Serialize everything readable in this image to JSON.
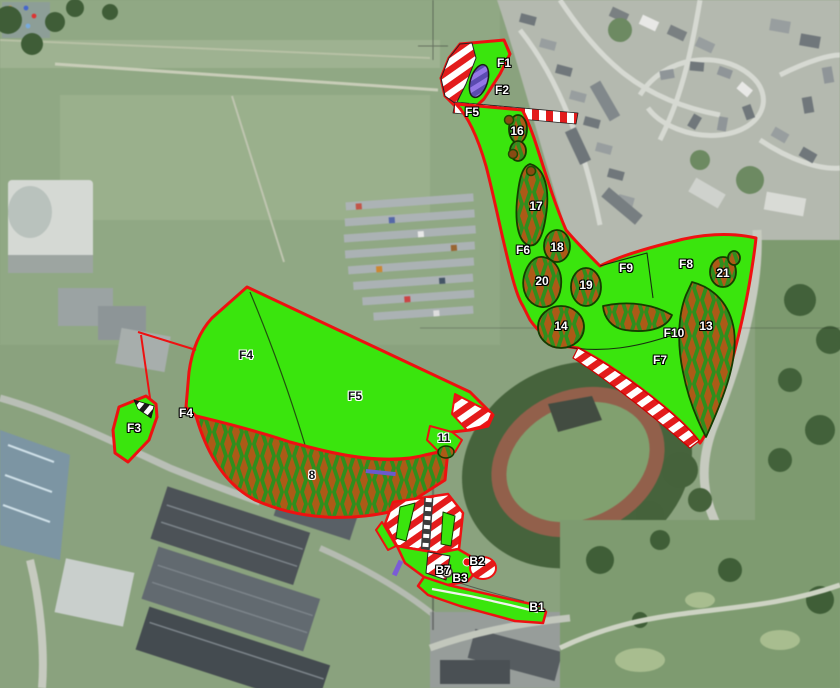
{
  "map": {
    "colors": {
      "zone_green": "#3ae50d",
      "border_red": "#ee1111",
      "checker_green": "#2f8f1d",
      "checker_brown": "#ad5a17",
      "stripe_red": "#e31c1c",
      "stripe_white": "#ffffff",
      "purple_light": "#9377e6",
      "purple_dark": "#5b4bb0",
      "tree_outline": "#143c00"
    },
    "zones": [
      {
        "id": "F1",
        "label": "F1",
        "x": 504,
        "y": 63,
        "style": "light"
      },
      {
        "id": "F2",
        "label": "F2",
        "x": 502,
        "y": 90,
        "style": "light"
      },
      {
        "id": "F5-north",
        "label": "F5",
        "x": 472,
        "y": 112,
        "style": "light"
      },
      {
        "id": "16",
        "label": "16",
        "x": 517,
        "y": 131,
        "style": "light"
      },
      {
        "id": "17",
        "label": "17",
        "x": 536,
        "y": 206,
        "style": "light"
      },
      {
        "id": "F6",
        "label": "F6",
        "x": 523,
        "y": 250,
        "style": "light"
      },
      {
        "id": "18",
        "label": "18",
        "x": 557,
        "y": 247,
        "style": "light"
      },
      {
        "id": "20",
        "label": "20",
        "x": 542,
        "y": 281,
        "style": "light"
      },
      {
        "id": "19",
        "label": "19",
        "x": 586,
        "y": 285,
        "style": "light"
      },
      {
        "id": "F9",
        "label": "F9",
        "x": 626,
        "y": 268,
        "style": "light"
      },
      {
        "id": "F8",
        "label": "F8",
        "x": 686,
        "y": 264,
        "style": "light"
      },
      {
        "id": "21",
        "label": "21",
        "x": 723,
        "y": 273,
        "style": "light"
      },
      {
        "id": "14",
        "label": "14",
        "x": 561,
        "y": 326,
        "style": "light"
      },
      {
        "id": "F10",
        "label": "F10",
        "x": 674,
        "y": 333,
        "style": "light"
      },
      {
        "id": "13",
        "label": "13",
        "x": 706,
        "y": 326,
        "style": "light"
      },
      {
        "id": "F7",
        "label": "F7",
        "x": 660,
        "y": 360,
        "style": "light"
      },
      {
        "id": "F4",
        "label": "F4",
        "x": 246,
        "y": 355,
        "style": "dark"
      },
      {
        "id": "F5",
        "label": "F5",
        "x": 355,
        "y": 396,
        "style": "dark"
      },
      {
        "id": "F4-west",
        "label": "F4",
        "x": 186,
        "y": 413,
        "style": "light"
      },
      {
        "id": "F3",
        "label": "F3",
        "x": 134,
        "y": 428,
        "style": "light"
      },
      {
        "id": "11",
        "label": "11",
        "x": 444,
        "y": 438,
        "style": "dark"
      },
      {
        "id": "8",
        "label": "8",
        "x": 312,
        "y": 475,
        "style": "dark"
      },
      {
        "id": "B7",
        "label": "B7",
        "x": 443,
        "y": 570,
        "style": "light"
      },
      {
        "id": "B2",
        "label": "B2",
        "x": 477,
        "y": 561,
        "style": "light"
      },
      {
        "id": "B3",
        "label": "B3",
        "x": 460,
        "y": 578,
        "style": "light"
      },
      {
        "id": "B1",
        "label": "B1",
        "x": 537,
        "y": 607,
        "style": "light"
      }
    ],
    "point_markers": [
      {
        "id": "survey-circle-b3",
        "type": "white-circle",
        "x": 447,
        "y": 572
      },
      {
        "id": "survey-dot-b2",
        "type": "red-dot",
        "x": 467,
        "y": 562
      },
      {
        "id": "tree-dot-1",
        "type": "tree",
        "x": 509,
        "y": 120
      },
      {
        "id": "tree-dot-2",
        "type": "tree",
        "x": 513,
        "y": 154
      },
      {
        "id": "tree-dot-3",
        "type": "tree",
        "x": 531,
        "y": 171
      }
    ]
  }
}
